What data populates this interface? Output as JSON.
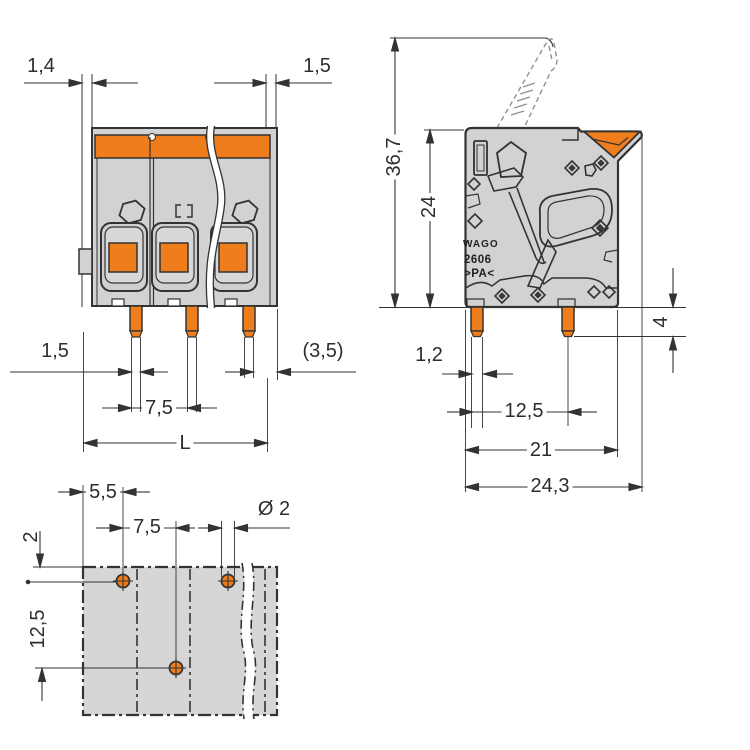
{
  "front": {
    "wall_left": "1,4",
    "wall_right": "1,5",
    "pin_width": "1,5",
    "pin_to_edge": "(3,5)",
    "pitch": "7,5",
    "overall_length": "L"
  },
  "side": {
    "total_height": "36,7",
    "body_height": "24",
    "pin_length": "4",
    "pin_width": "1,2",
    "pin_spacing": "12,5",
    "depth": "21",
    "total_depth": "24,3",
    "brand": "WAGO",
    "series": "2606",
    "material": ">PA<"
  },
  "footprint": {
    "edge_to_hole": "5,5",
    "hole_pitch": "7,5",
    "hole_diameter": "Ø 2",
    "row_offset": "2",
    "row_spacing": "12,5"
  },
  "colors": {
    "accent_orange": "#EF7D1C",
    "body_gray": "#D2D2D2",
    "line_dark": "#333333"
  }
}
